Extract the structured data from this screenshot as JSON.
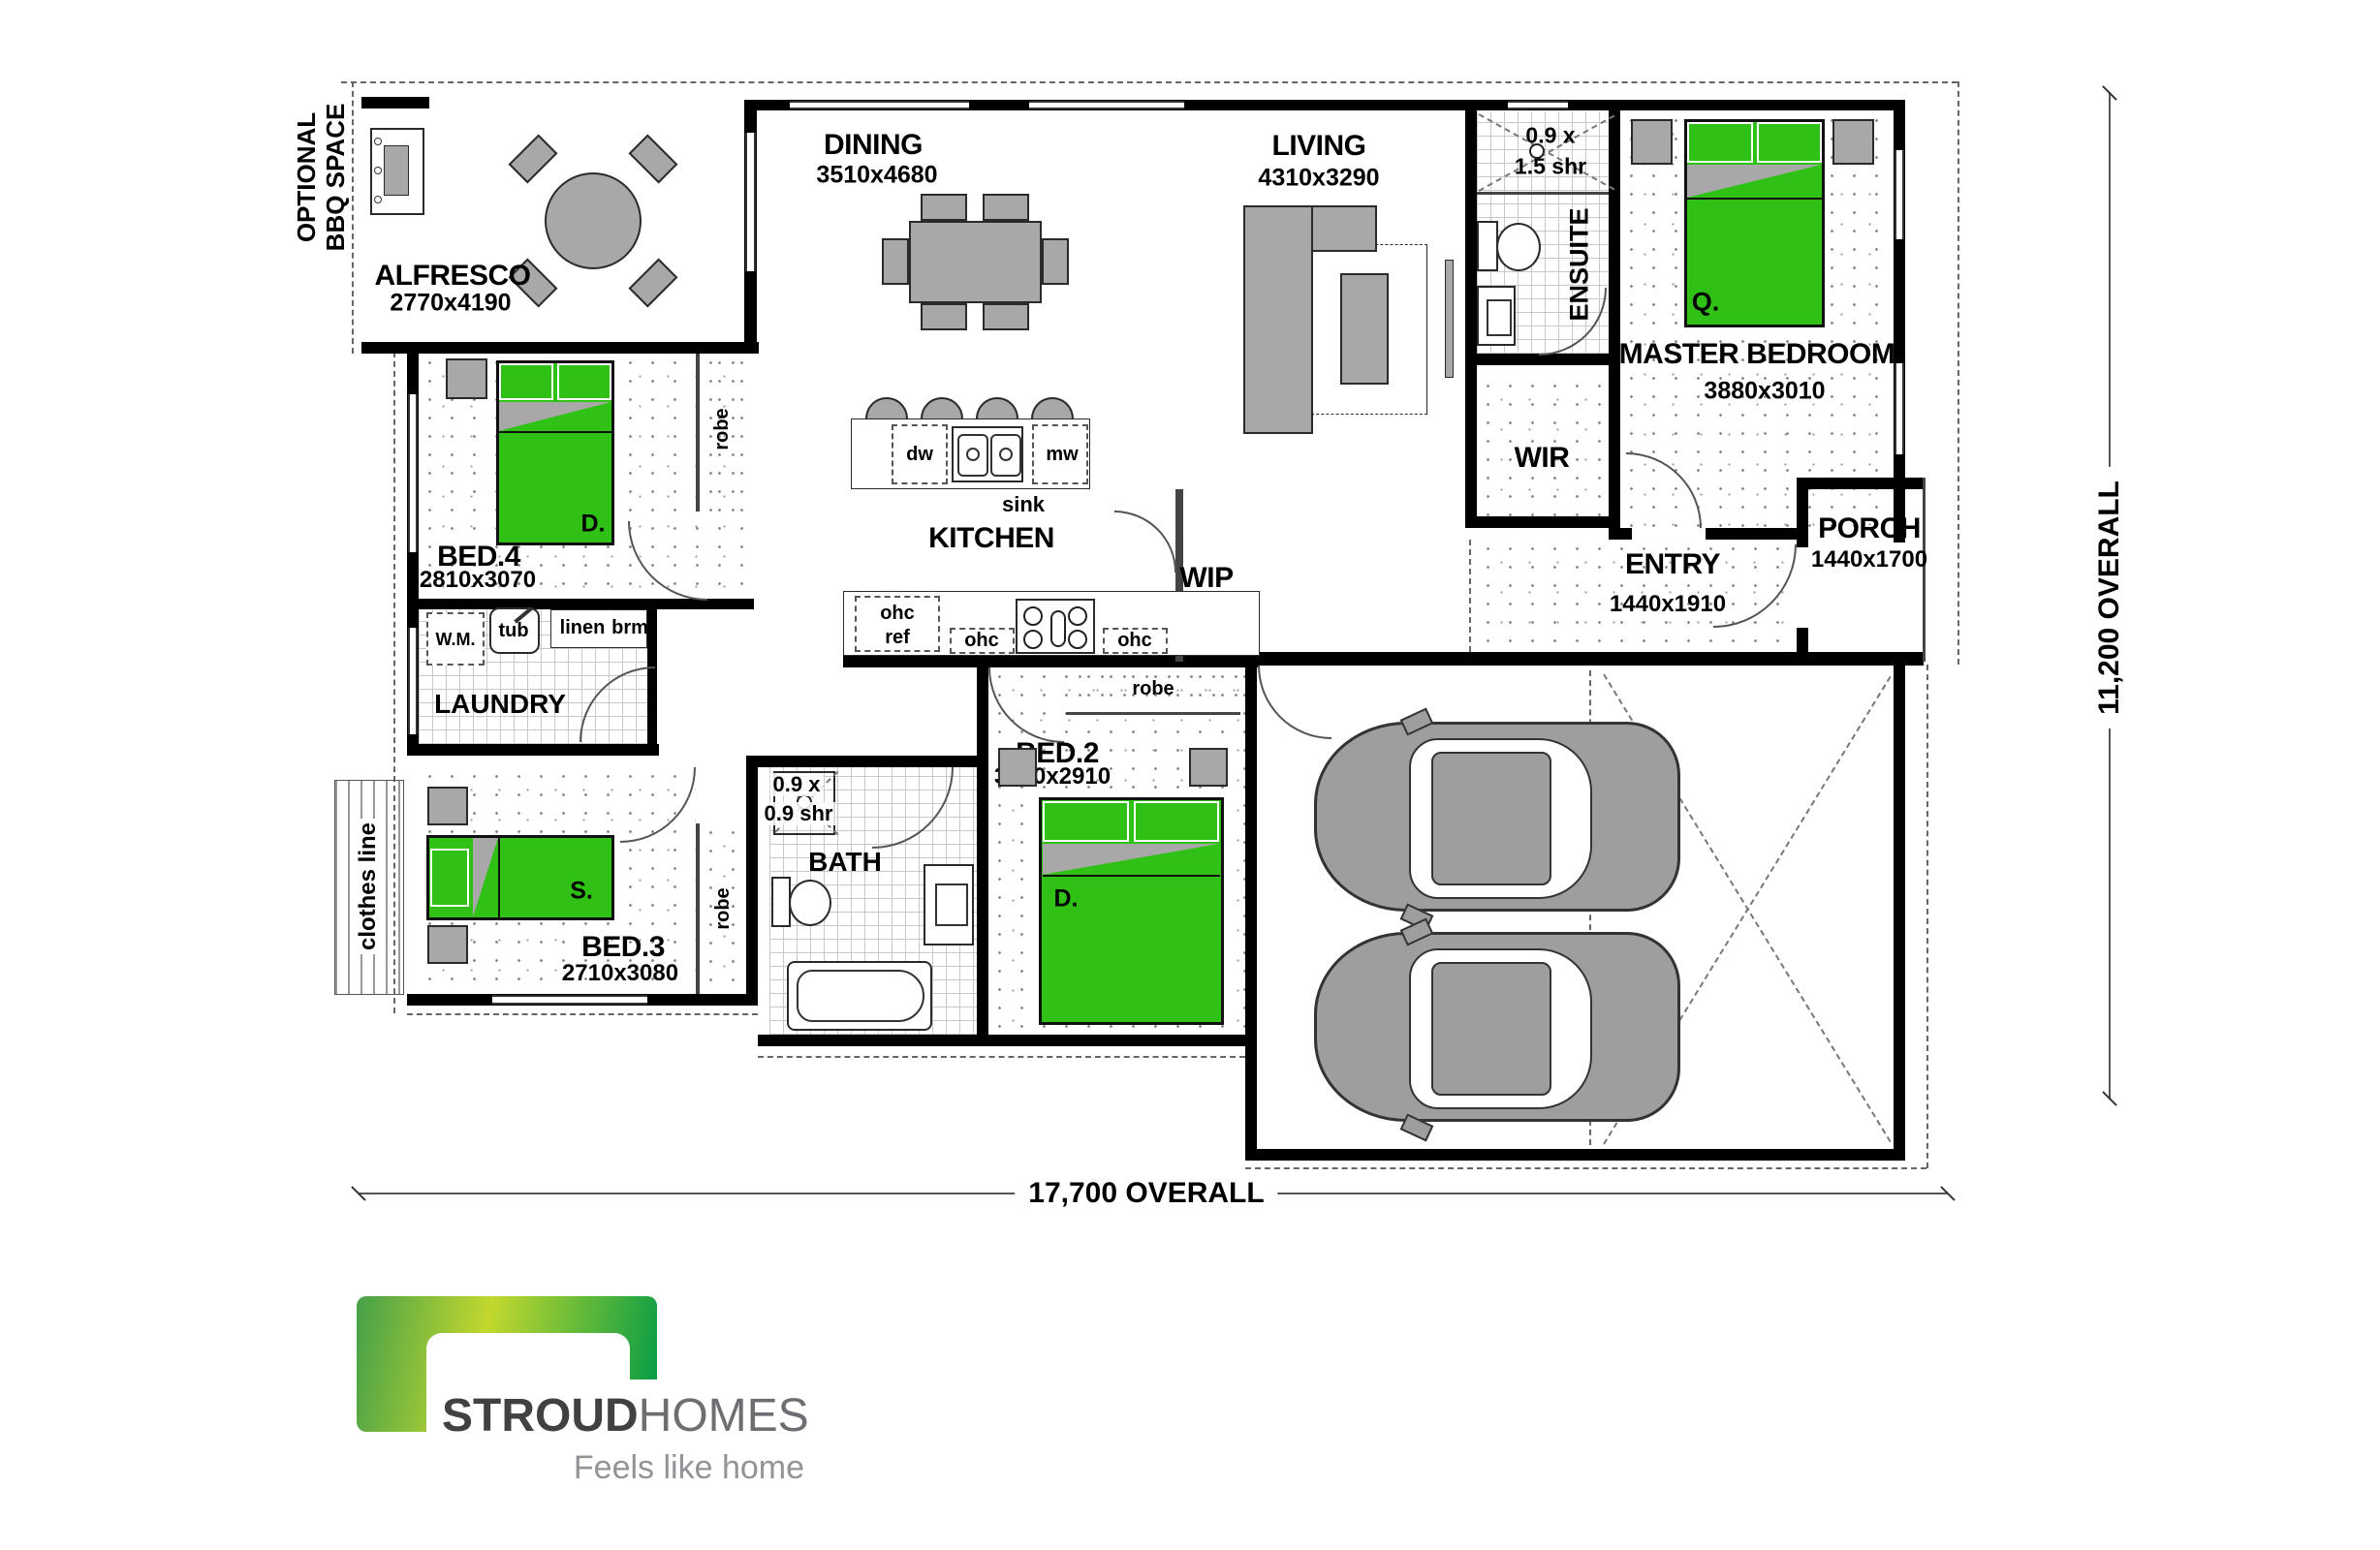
{
  "dimensions": {
    "overall_width": "17,700 OVERALL",
    "overall_height": "11,200 OVERALL"
  },
  "annotations": {
    "optional_bbq_line1": "OPTIONAL",
    "optional_bbq_line2": "BBQ SPACE",
    "clothes_line": "clothes line"
  },
  "rooms": {
    "alfresco": {
      "name": "ALFRESCO",
      "dims": "2770x4190"
    },
    "dining": {
      "name": "DINING",
      "dims": "3510x4680"
    },
    "living": {
      "name": "LIVING",
      "dims": "4310x3290"
    },
    "ensuite": {
      "name": "ENSUITE",
      "shower_l1": "0.9 x",
      "shower_l2": "1.5 shr"
    },
    "master": {
      "name": "MASTER BEDROOM",
      "dims": "3880x3010",
      "bed_tag": "Q."
    },
    "wir": {
      "name": "WIR"
    },
    "porch": {
      "name": "PORCH",
      "dims": "1440x1700"
    },
    "entry": {
      "name": "ENTRY",
      "dims": "1440x1910"
    },
    "bed4": {
      "name": "BED.4",
      "dims": "2810x3070",
      "bed_tag": "D."
    },
    "kitchen": {
      "name": "KITCHEN",
      "sink": "sink",
      "dw": "dw",
      "mw": "mw"
    },
    "wip": {
      "name": "WIP"
    },
    "laundry": {
      "name": "LAUNDRY",
      "wm": "W.M.",
      "tub": "tub",
      "linen": "linen",
      "brm": "brm"
    },
    "bath": {
      "name": "BATH",
      "shower_l1": "0.9 x",
      "shower_l2": "0.9 shr"
    },
    "bed2": {
      "name": "BED.2",
      "dims": "3180x2910",
      "bed_tag": "D."
    },
    "bed3": {
      "name": "BED.3",
      "dims": "2710x3080",
      "bed_tag": "S."
    },
    "garage": {
      "name": "GARAGE",
      "dims": "5600x6020"
    }
  },
  "fixtures": {
    "robe": "robe",
    "ohc": "ohc",
    "ref": "ref"
  },
  "logo": {
    "brand_primary": "STROUD",
    "brand_secondary": "HOMES",
    "tagline": "Feels like home"
  }
}
